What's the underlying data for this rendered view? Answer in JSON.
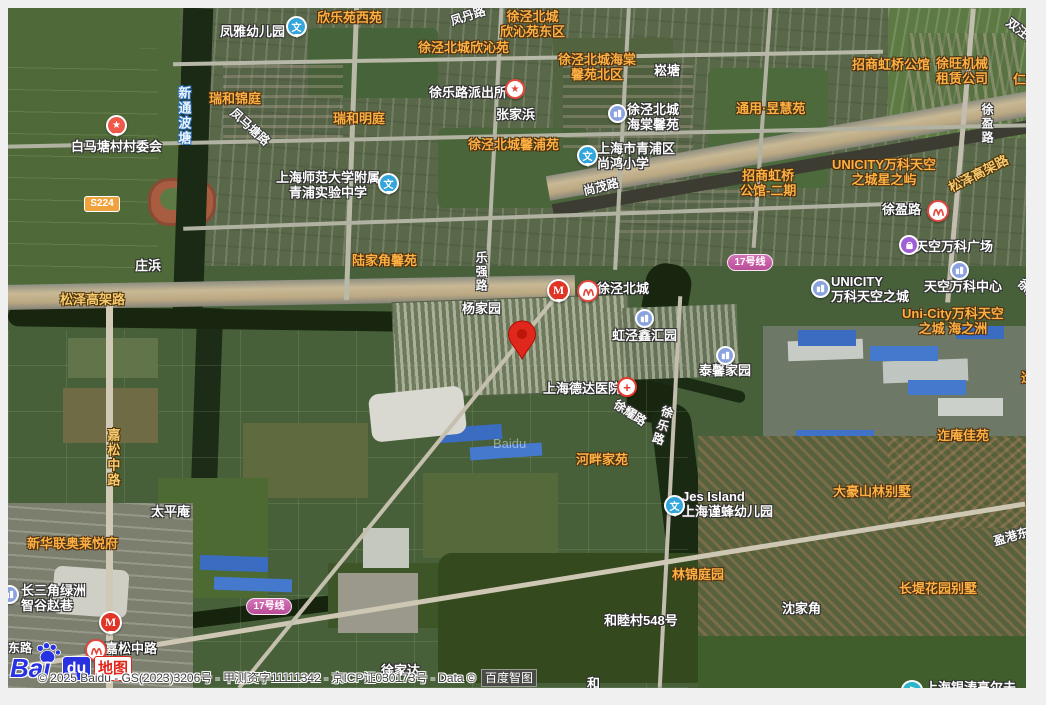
{
  "attribution": {
    "copyright": "© 2025 Baidu - GS(2023)3206号 - 甲测资字11111342 - 京ICP证030173号 - Data © ",
    "brand_box": "百度智图"
  },
  "logo": {
    "bai": "Bai",
    "du": "du",
    "suffix": "地图"
  },
  "watermark": "Baidu",
  "colors": {
    "residential_label": "#fdb044",
    "road_label": "#ffffff",
    "highway_label": "#f8c96e",
    "water_label_halo": "#2b6fb5",
    "metro_line17": "#b94d97",
    "marker_red": "#e0271b",
    "provincial_road_badge": "#f0a33c",
    "baidu_blue": "#2932e1",
    "baidu_red": "#e1251b"
  },
  "marker": {
    "x": 499,
    "y": 312,
    "tip_x": 514,
    "tip_y": 350
  },
  "labels": [
    {
      "n": "label-fengya-kindergarten",
      "t": "凤雅幼儿园",
      "c": "wh",
      "x": 212,
      "y": 16
    },
    {
      "n": "label-xinleyuan-west",
      "t": "欣乐苑西苑",
      "c": "or",
      "x": 309,
      "y": 2
    },
    {
      "n": "label-fengdan-road",
      "t": "凤丹路",
      "c": "rd",
      "x": 442,
      "y": 1,
      "r": -18
    },
    {
      "n": "label-xqbc-xinqinyuan-east",
      "lines": [
        "徐泾北城",
        "欣沁苑东区"
      ],
      "c": "or ctr",
      "x": 492,
      "y": 1
    },
    {
      "n": "label-xqbc-xinqinyuan",
      "t": "徐泾北城欣沁苑",
      "c": "or",
      "x": 410,
      "y": 32
    },
    {
      "n": "label-xqbc-haitang-north",
      "lines": [
        "徐泾北城海棠",
        "馨苑北区"
      ],
      "c": "or ctr",
      "x": 550,
      "y": 44
    },
    {
      "n": "label-songtang",
      "t": "崧塘",
      "c": "wh",
      "x": 646,
      "y": 55
    },
    {
      "n": "label-ruihe-jinting",
      "t": "瑞和锦庭",
      "c": "or",
      "x": 201,
      "y": 83
    },
    {
      "n": "label-ruihe-mingting",
      "t": "瑞和明庭",
      "c": "or",
      "x": 325,
      "y": 103
    },
    {
      "n": "label-xintongbotang-river",
      "t": "新通波塘",
      "c": "wa v",
      "x": 168,
      "y": 78
    },
    {
      "n": "label-fengmatang-road",
      "t": "凤马塘路",
      "c": "rd",
      "x": 218,
      "y": 112,
      "r": 42
    },
    {
      "n": "label-baimatang-village-committee",
      "t": "白马塘村村委会",
      "c": "wh",
      "x": 63,
      "y": 131
    },
    {
      "n": "label-xulelu-police-station",
      "t": "徐乐路派出所",
      "c": "wh",
      "x": 421,
      "y": 77
    },
    {
      "n": "label-zhangjiabang",
      "t": "张家浜",
      "c": "wh",
      "x": 488,
      "y": 99
    },
    {
      "n": "label-xqbc-haitang-xinyuan",
      "lines": [
        "徐泾北城",
        "海棠馨苑"
      ],
      "c": "wh",
      "x": 619,
      "y": 94
    },
    {
      "n": "label-tongyong-yuhuiyuan",
      "t": "通用·昱慧苑",
      "c": "or",
      "x": 728,
      "y": 93
    },
    {
      "n": "label-zhaoshang-hongqiao",
      "t": "招商虹桥公馆",
      "c": "or",
      "x": 844,
      "y": 49
    },
    {
      "n": "label-xuwang-machinery",
      "lines": [
        "徐旺机械",
        "租赁公司"
      ],
      "c": "or ctr",
      "x": 928,
      "y": 48
    },
    {
      "n": "label-shuangwangtang",
      "t": "双汪塘",
      "c": "rd",
      "x": 996,
      "y": 17,
      "r": 38
    },
    {
      "n": "label-renheng",
      "t": "仁恒",
      "c": "or",
      "x": 1005,
      "y": 64
    },
    {
      "n": "label-xqbc-xinpuyuan",
      "t": "徐泾北城馨浦苑",
      "c": "or",
      "x": 460,
      "y": 129
    },
    {
      "n": "label-shanghong-primary-school",
      "lines": [
        "上海市青浦区",
        "尚鸿小学"
      ],
      "c": "wh",
      "x": 589,
      "y": 133
    },
    {
      "n": "label-zhaoshang-hongqiao-phase2",
      "lines": [
        "招商虹桥",
        "公馆-二期"
      ],
      "c": "or ctr",
      "x": 732,
      "y": 160
    },
    {
      "n": "label-unicity-star-isle",
      "lines": [
        "UNICITY万科天空",
        "之城星之屿"
      ],
      "c": "or ctr",
      "x": 824,
      "y": 149
    },
    {
      "n": "label-shanghai-normal-univ-school",
      "lines": [
        "上海师范大学附属",
        "青浦实验中学"
      ],
      "c": "wh ctr",
      "x": 268,
      "y": 162
    },
    {
      "n": "label-shangmao-road",
      "t": "尚茂路",
      "c": "rd",
      "x": 575,
      "y": 172,
      "r": -14
    },
    {
      "n": "label-songze-elevated-road-east",
      "t": "松泽高架路",
      "c": "hwy",
      "x": 938,
      "y": 158,
      "r": -27
    },
    {
      "n": "label-xuying-road-station",
      "t": "徐盈路",
      "c": "mt",
      "x": 874,
      "y": 194
    },
    {
      "n": "label-xuying-road",
      "t": "徐盈路",
      "c": "rd v",
      "x": 972,
      "y": 95
    },
    {
      "n": "label-tiankong-wanke-plaza",
      "t": "天空万科广场",
      "c": "wh",
      "x": 907,
      "y": 231
    },
    {
      "n": "label-unicity-tiankong",
      "lines": [
        "UNICITY",
        "万科天空之城"
      ],
      "c": "wh",
      "x": 823,
      "y": 266
    },
    {
      "n": "label-tiankong-wanke-center",
      "t": "天空万科中心",
      "c": "wh",
      "x": 916,
      "y": 271
    },
    {
      "n": "label-unicity-haizhizhou",
      "lines": [
        "Uni-City万科天空",
        "之城 海之洲"
      ],
      "c": "or ctr",
      "x": 894,
      "y": 298
    },
    {
      "n": "label-songze-elevated-road-west",
      "t": "松泽高架路",
      "c": "hwy",
      "x": 52,
      "y": 284
    },
    {
      "n": "label-zhuangbang",
      "t": "庄浜",
      "c": "wh",
      "x": 127,
      "y": 250
    },
    {
      "n": "label-xujing-north-city-station",
      "t": "徐泾北城",
      "c": "mt",
      "x": 589,
      "y": 273
    },
    {
      "n": "label-yangjiayuan",
      "t": "杨家园",
      "c": "wh",
      "x": 454,
      "y": 293
    },
    {
      "n": "label-leqiang-road",
      "t": "乐强路",
      "c": "rd v",
      "x": 466,
      "y": 243
    },
    {
      "n": "label-hongjing-xinhuiyuan",
      "t": "虹泾鑫汇园",
      "c": "wh",
      "x": 604,
      "y": 320
    },
    {
      "n": "label-taixin-jiayuan",
      "t": "泰馨家园",
      "c": "wh",
      "x": 691,
      "y": 355
    },
    {
      "n": "label-deda-hospital",
      "t": "上海德达医院",
      "c": "wh",
      "x": 535,
      "y": 373
    },
    {
      "n": "label-xuyao-road",
      "t": "徐耀路",
      "c": "rd",
      "x": 604,
      "y": 398,
      "r": 33
    },
    {
      "n": "label-xule-road",
      "t": "徐乐路",
      "c": "rd v",
      "x": 647,
      "y": 397,
      "r": 18
    },
    {
      "n": "label-hepan-jiayuan",
      "t": "河畔家苑",
      "c": "or",
      "x": 568,
      "y": 444
    },
    {
      "n": "label-jes-island-kindergarten",
      "lines": [
        "Jes Island",
        "上海谨蜂幼儿园"
      ],
      "c": "wh",
      "x": 674,
      "y": 481
    },
    {
      "n": "label-dahao-villas",
      "t": "大豪山林别墅",
      "c": "or",
      "x": 825,
      "y": 476
    },
    {
      "n": "label-zean-jiayuan",
      "t": "迮庵佳苑",
      "c": "or",
      "x": 929,
      "y": 420
    },
    {
      "n": "label-zean-partial",
      "t": "迮",
      "c": "or",
      "x": 1013,
      "y": 362
    },
    {
      "n": "label-xujing-road-partial",
      "t": "徐泾",
      "c": "rd",
      "x": 1008,
      "y": 275,
      "r": 48
    },
    {
      "n": "label-linjin-tingyuan",
      "t": "林锦庭园",
      "c": "or",
      "x": 664,
      "y": 559
    },
    {
      "n": "label-changdi-garden-villas",
      "t": "长堤花园别墅",
      "c": "or",
      "x": 891,
      "y": 573
    },
    {
      "n": "label-shenjiajiao",
      "t": "沈家角",
      "c": "wh",
      "x": 774,
      "y": 593
    },
    {
      "n": "label-yinggang-east-road",
      "t": "盈港东路",
      "c": "rd",
      "x": 985,
      "y": 520,
      "r": -16
    },
    {
      "n": "label-hemucun-548",
      "t": "和睦村548号",
      "c": "wh",
      "x": 596,
      "y": 605
    },
    {
      "n": "label-taipingan",
      "t": "太平庵",
      "c": "wh",
      "x": 143,
      "y": 496
    },
    {
      "n": "label-xinhualian-aolai",
      "t": "新华联奥莱悦府",
      "c": "or",
      "x": 19,
      "y": 528
    },
    {
      "n": "label-changsanjiao-zhigu",
      "lines": [
        "长三角绿洲",
        "智谷赵巷"
      ],
      "c": "wh",
      "x": 13,
      "y": 575
    },
    {
      "n": "label-jiasong-middle-road",
      "t": "嘉松中路",
      "c": "hwy v",
      "x": 97,
      "y": 420
    },
    {
      "n": "label-jiasong-middle-road-station",
      "t": "嘉松中路",
      "c": "mt",
      "x": 97,
      "y": 633
    },
    {
      "n": "label-xujiada",
      "t": "徐家达",
      "c": "wh",
      "x": 373,
      "y": 655
    },
    {
      "n": "label-he-partial",
      "t": "和",
      "c": "wh",
      "x": 579,
      "y": 668
    },
    {
      "n": "label-donglu-partial",
      "t": "东路",
      "c": "rd",
      "x": 0,
      "y": 633
    },
    {
      "n": "label-yintao-golf",
      "t": "上海银涛高尔夫",
      "c": "wh",
      "x": 917,
      "y": 672
    },
    {
      "n": "label-lujiajiao-xinyuan",
      "t": "陆家角馨苑",
      "c": "or",
      "x": 344,
      "y": 245
    }
  ],
  "pins": [
    {
      "n": "pin-fengya-school",
      "type": "school",
      "x": 278,
      "y": 8
    },
    {
      "n": "pin-police-station",
      "type": "police",
      "x": 497,
      "y": 71
    },
    {
      "n": "pin-baimatang-committee",
      "type": "star",
      "x": 98,
      "y": 107
    },
    {
      "n": "pin-normal-univ-school",
      "type": "school",
      "x": 370,
      "y": 165
    },
    {
      "n": "pin-shanghong-school",
      "type": "school",
      "x": 569,
      "y": 137
    },
    {
      "n": "pin-haitang-residence",
      "type": "building",
      "x": 600,
      "y": 96
    },
    {
      "n": "pin-metro-xuying-road",
      "type": "metro",
      "x": 919,
      "y": 192
    },
    {
      "n": "pin-wanke-plaza-mall",
      "type": "mall",
      "x": 891,
      "y": 227
    },
    {
      "n": "pin-unicity-building",
      "type": "building",
      "x": 803,
      "y": 271
    },
    {
      "n": "pin-wanke-center-building",
      "type": "building",
      "x": 942,
      "y": 253
    },
    {
      "n": "pin-mcdonalds-xujing",
      "type": "mcdonalds",
      "x": 539,
      "y": 271
    },
    {
      "n": "pin-metro-xujing-north-city",
      "type": "metro",
      "x": 569,
      "y": 272
    },
    {
      "n": "pin-hongjing-building",
      "type": "building",
      "x": 627,
      "y": 301
    },
    {
      "n": "pin-taixin-building",
      "type": "building",
      "x": 708,
      "y": 338
    },
    {
      "n": "pin-deda-hospital",
      "type": "hospital",
      "x": 609,
      "y": 369
    },
    {
      "n": "pin-jes-island-school",
      "type": "school",
      "x": 656,
      "y": 487
    },
    {
      "n": "pin-mcdonalds-jiasong",
      "type": "mcdonalds",
      "x": 91,
      "y": 603
    },
    {
      "n": "pin-metro-jiasong-road",
      "type": "metro",
      "x": 77,
      "y": 631
    },
    {
      "n": "pin-edge-building",
      "type": "building",
      "x": -8,
      "y": 577
    },
    {
      "n": "pin-yintao-golf",
      "type": "golf",
      "x": 893,
      "y": 672
    }
  ],
  "badges": [
    {
      "n": "badge-metro-line17-north",
      "t": "17号线",
      "type": "line17",
      "x": 719,
      "y": 246
    },
    {
      "n": "badge-metro-line17-south",
      "t": "17号线",
      "type": "line17",
      "x": 238,
      "y": 590
    },
    {
      "n": "badge-provincial-road-s224",
      "t": "S224",
      "type": "s224",
      "x": 76,
      "y": 188
    }
  ]
}
